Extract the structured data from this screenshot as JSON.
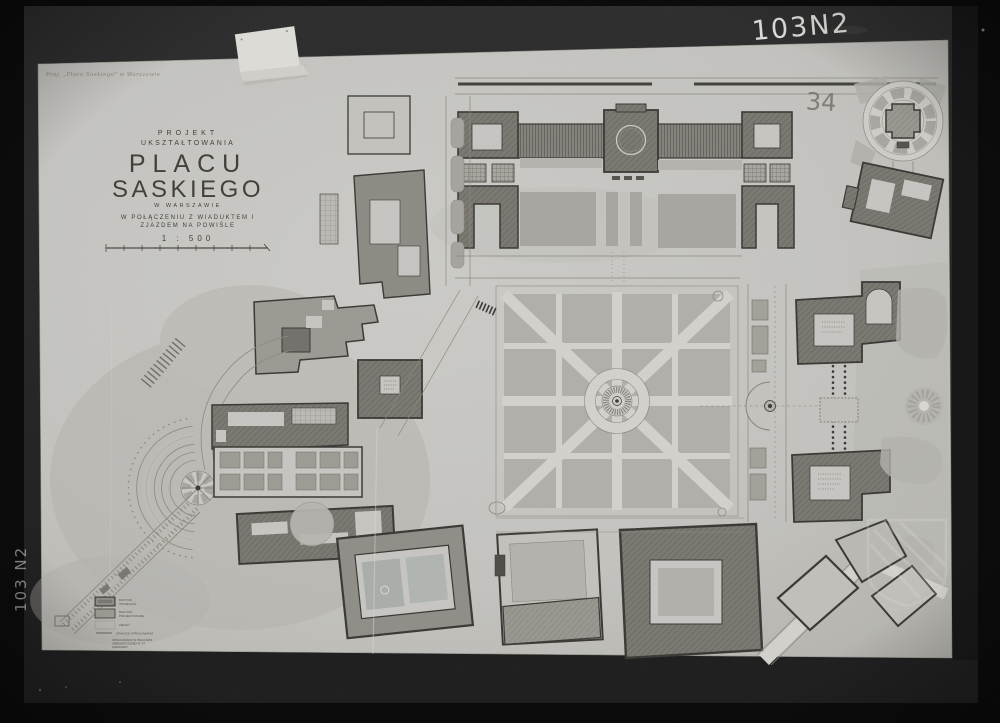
{
  "photo": {
    "frame_marks": {
      "chalk_number_top_right": "103N2",
      "chalk_number_left_edge": "103 N2",
      "pencil_number_on_sheet": "34"
    }
  },
  "caption_top_left": "Proj. „Placu Saskiego” w Warszawie",
  "title_block": {
    "kicker_line1": "PROJEKT",
    "kicker_line2": "UKSZTAŁTOWANIA",
    "title_line1": "PLACU",
    "title_line2": "SASKIEGO",
    "subtitle": "W WARSZAWIE",
    "note_line1": "W POŁĄCZENIU Z WIADUKTEM I",
    "note_line2": "ZJAZDEM NA POWIŚLE",
    "scale_label": "1 : 500"
  },
  "legend": {
    "items": [
      {
        "l1": "BUDYNKI",
        "l2": "ISTNIEJĄCE"
      },
      {
        "l1": "BUDYNKI",
        "l2": "PROJEKTOWANE"
      },
      {
        "l1": "ZIELEŃ",
        "l2": ""
      },
      {
        "l1": "GRANICE OPRACOWANIA",
        "l2": ""
      }
    ],
    "note": [
      "OPRACOWANO W PRACOWNI",
      "URBANISTYCZNEJ M. ST.",
      "WARSZAWY"
    ]
  },
  "colors": {
    "background": "#0a0a0a",
    "frame": "#262626",
    "sheet": "#c6c5c1",
    "building_existing": "#7a7871",
    "building_projected": "#989790",
    "greenery": "#b0afa9",
    "ink": "#3a3935",
    "chalk": "#e6e6e2"
  }
}
